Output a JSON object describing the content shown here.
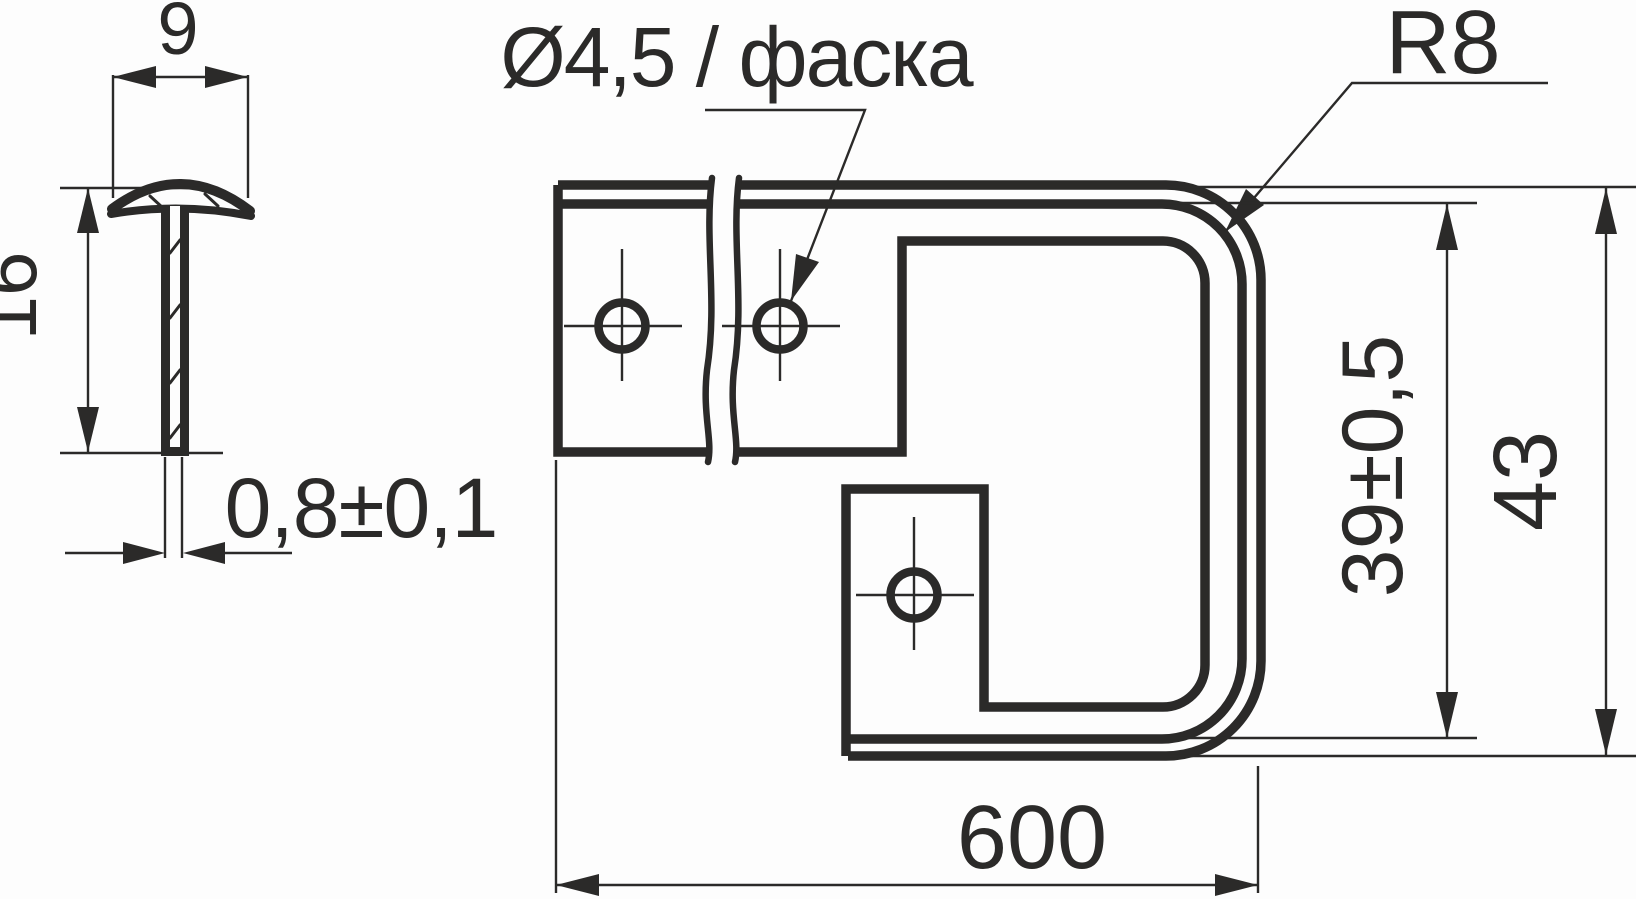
{
  "drawing": {
    "type": "technical-drawing",
    "views": {
      "cross_section": {
        "description": "T-profile cross-section (left view)",
        "cap_width_dim": "9",
        "height_dim": "16",
        "wall_thickness_dim": "0,8±0,1"
      },
      "main_view": {
        "description": "Front view of bent profile with mounting holes",
        "hole_callout": "Ø4,5 / фаска",
        "corner_radius_callout": "R8",
        "inner_height_dim": "39±0,5",
        "overall_height_dim": "43",
        "length_dim": "600",
        "hole_count_visible": 3
      }
    },
    "colors": {
      "line": "#2b2a29",
      "background": "#fdfdfd"
    }
  }
}
